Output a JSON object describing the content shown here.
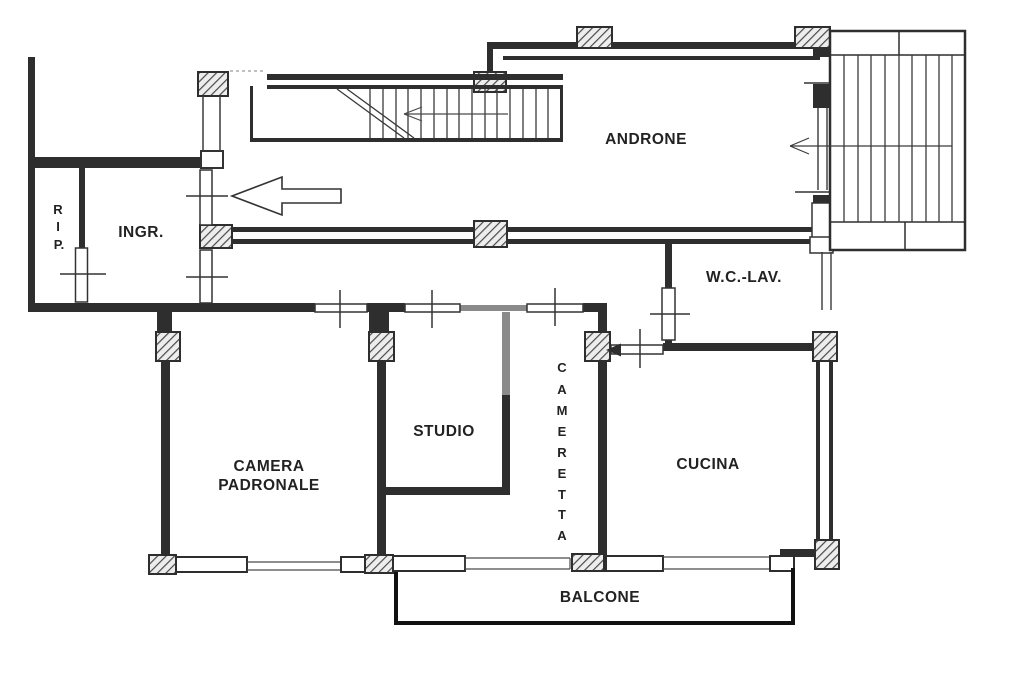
{
  "rooms": {
    "rip": {
      "letters": [
        "R",
        "I",
        "P."
      ]
    },
    "ingr": {
      "label": "INGR."
    },
    "androne": {
      "label": "ANDRONE"
    },
    "wc_lav": {
      "label": "W.C.-LAV."
    },
    "camera_padronale": {
      "line1": "CAMERA",
      "line2": "PADRONALE"
    },
    "studio": {
      "label": "STUDIO"
    },
    "cameretta": {
      "letters": [
        "C",
        "A",
        "M",
        "E",
        "R",
        "E",
        "T",
        "T",
        "A"
      ]
    },
    "cucina": {
      "label": "CUCINA"
    },
    "balcone": {
      "label": "BALCONE"
    }
  },
  "icons": {
    "entrance_arrow": "large outlined arrow pointing left into entrance door",
    "upper_stair_arrow": "small left arrow on upper stair flight",
    "main_stair_arrow": "left arrow on main staircase",
    "wc_door_arrow": "solid left arrowhead at w.c. door"
  },
  "colors": {
    "ink": "#2e2e2e",
    "paper": "#ffffff",
    "gray_wall": "#8a8a8a",
    "balcony_line": "#111111"
  }
}
